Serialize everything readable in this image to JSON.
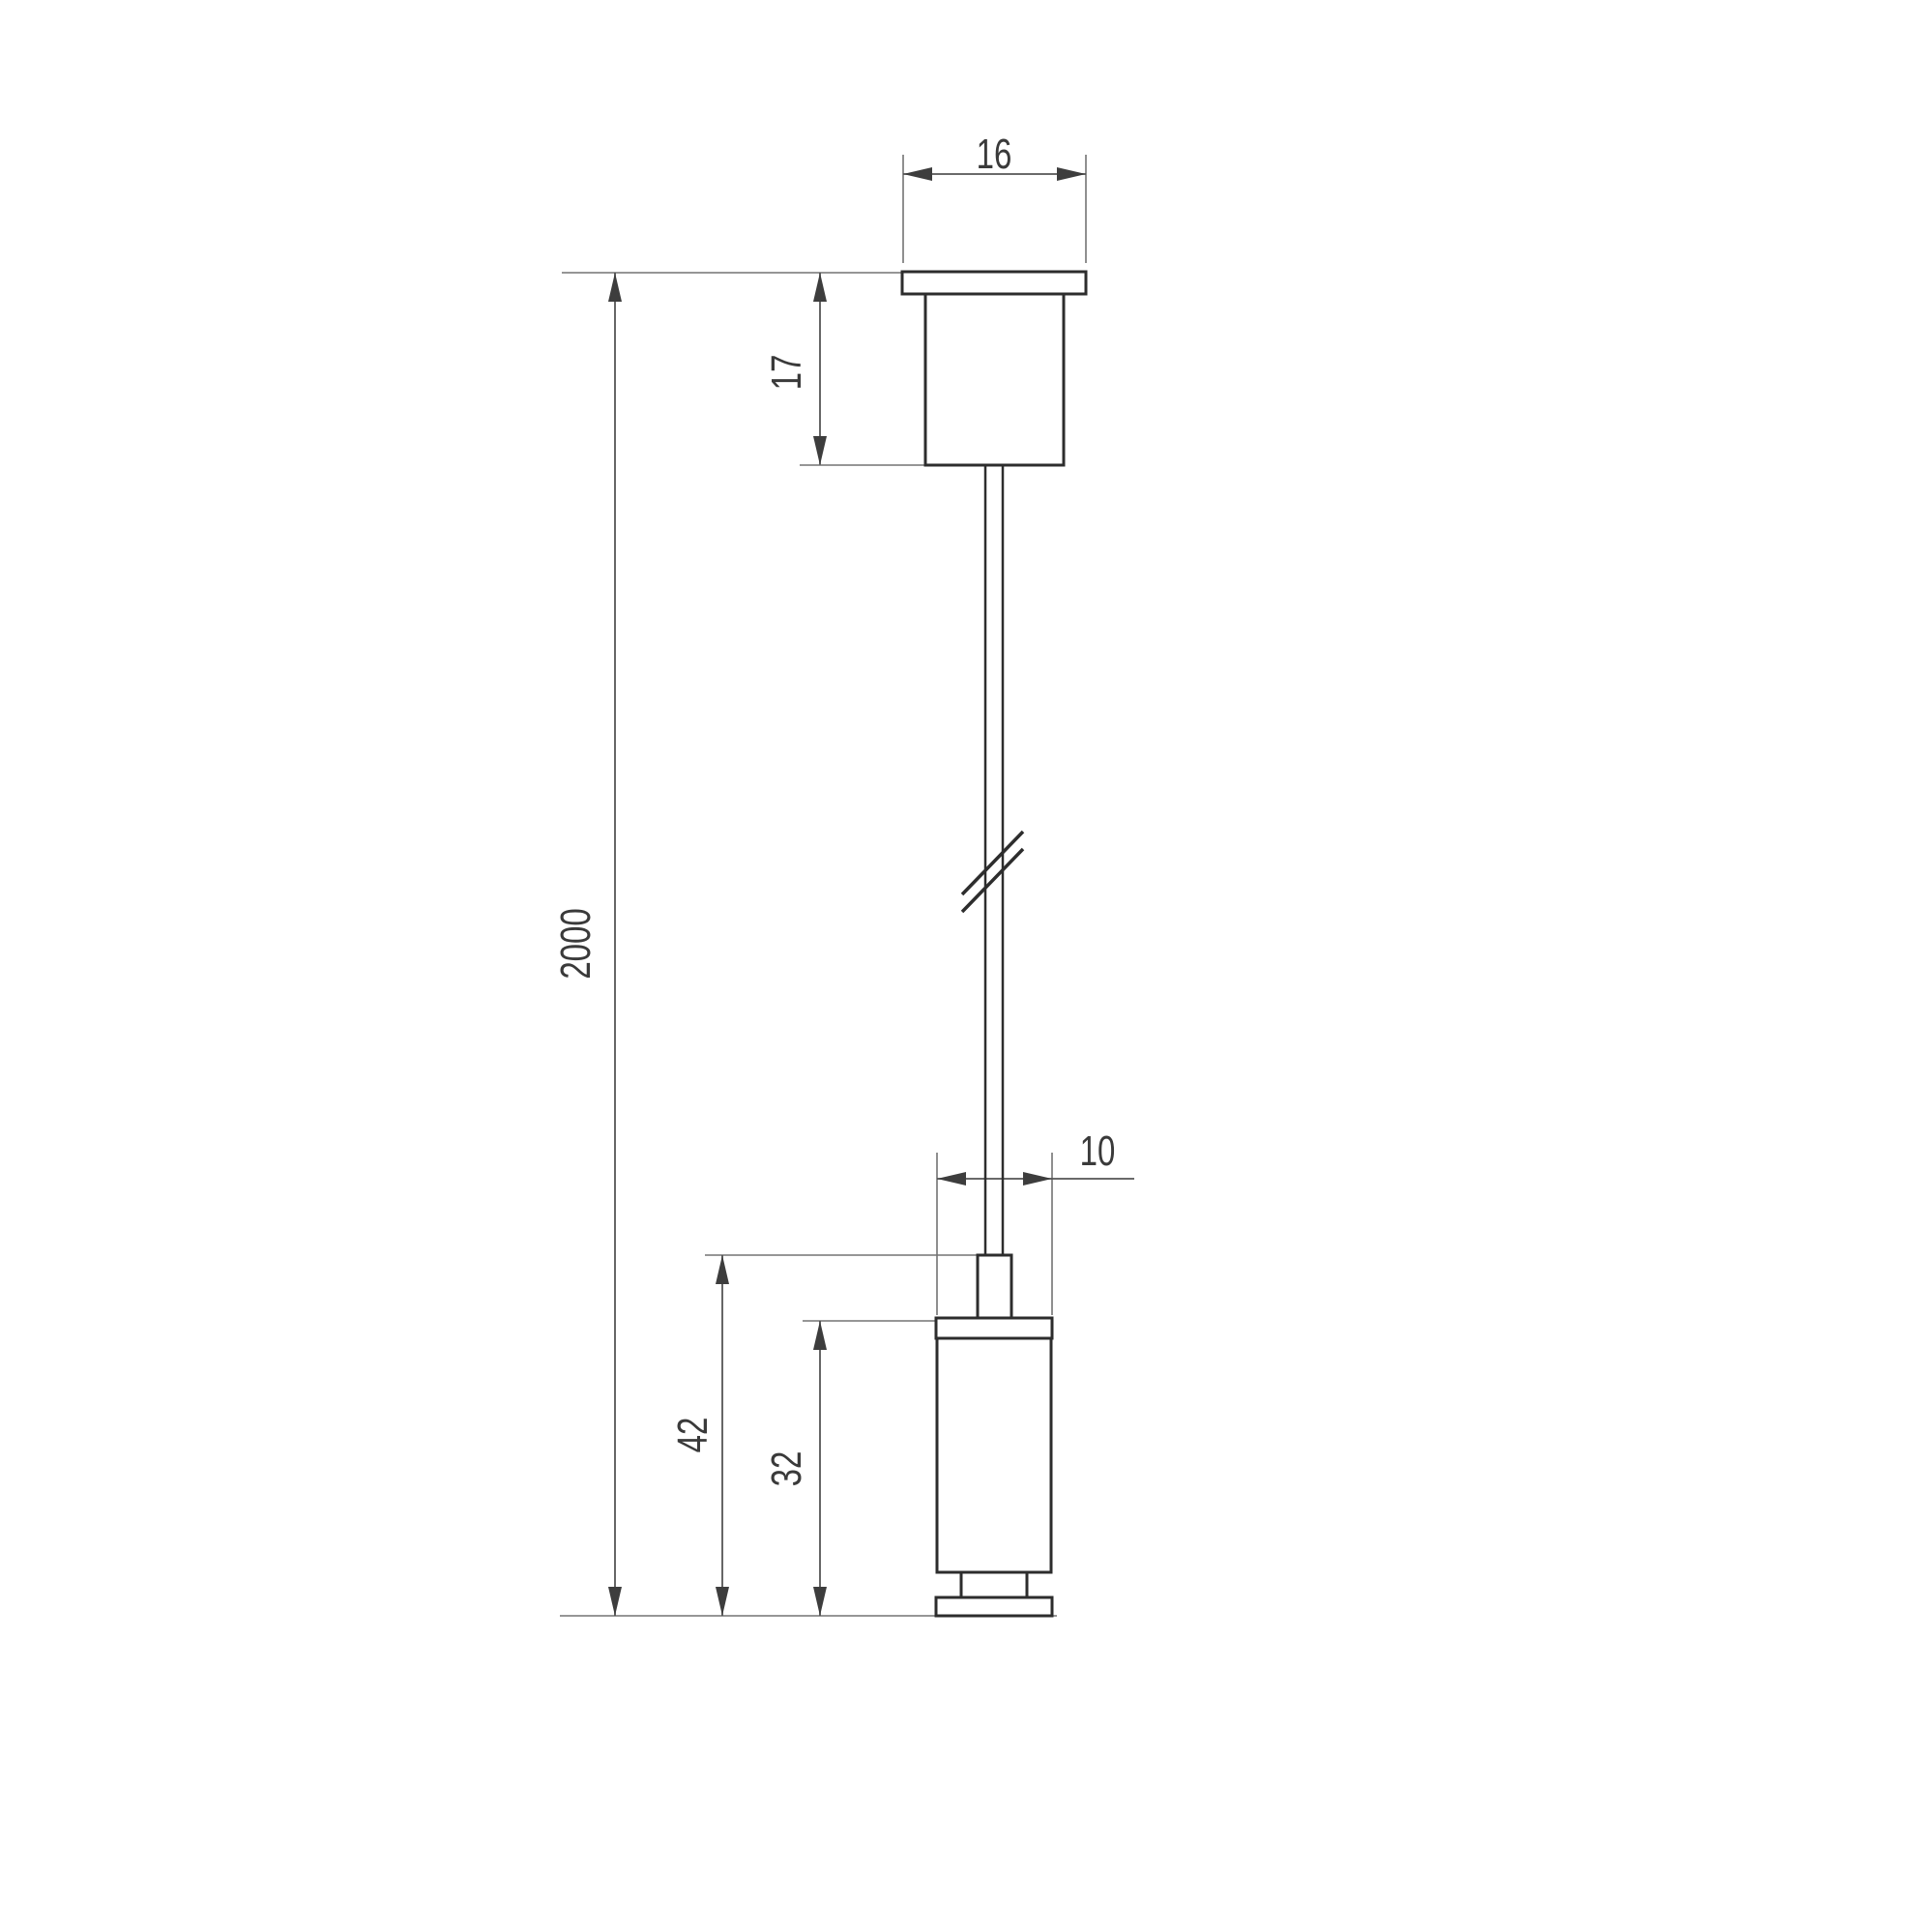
{
  "drawing": {
    "type": "technical-dimension-drawing",
    "subject": "suspension-cable-kit-side-view",
    "dimensions": {
      "canopy_width": "16",
      "canopy_height": "17",
      "cable_length": "2000",
      "gripper_flange_width": "10",
      "lower_fixture_total_height": "42",
      "lower_fixture_body_height": "32"
    },
    "colors": {
      "background": "#ffffff",
      "object_line": "#2d2d2d",
      "dimension_line": "#737373",
      "dimension_main": "#555555",
      "arrow": "#3d3d3d",
      "label_text": "#3a3a3a"
    }
  }
}
